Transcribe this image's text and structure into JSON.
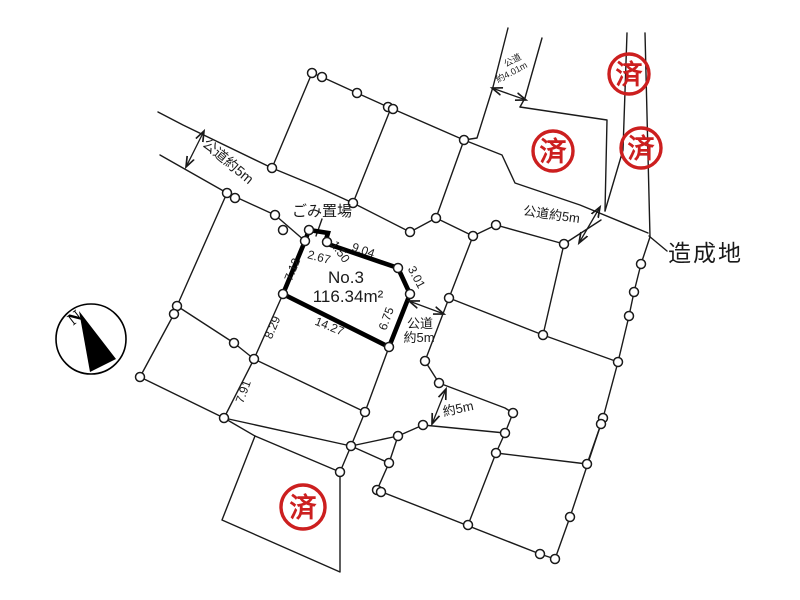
{
  "diagram": {
    "plot": {
      "label": "No.3",
      "area": "116.34m²"
    },
    "dimensions": [
      {
        "value": "9.04"
      },
      {
        "value": "1.50"
      },
      {
        "value": "2.67"
      },
      {
        "value": "7.12"
      },
      {
        "value": "3.01"
      },
      {
        "value": "6.75"
      },
      {
        "value": "14.27"
      },
      {
        "value": "8.29"
      },
      {
        "value": "7.91"
      }
    ],
    "roads": {
      "nw": "公道約5m",
      "ne": "公道約5m",
      "top_line1": "公道",
      "top_line2": "約4.01m",
      "center_line1": "公道",
      "center_line2": "約5m",
      "south": "約5m"
    },
    "labels": {
      "garbage": "ごみ置場",
      "developed": "造成地"
    },
    "compass": {
      "letter": "N"
    },
    "stamps": [
      {
        "text": "済"
      },
      {
        "text": "済"
      },
      {
        "text": "済"
      },
      {
        "text": "済"
      }
    ],
    "colors": {
      "stamp_red": "#cc1f1f",
      "line_black": "#1a1a1a"
    }
  }
}
